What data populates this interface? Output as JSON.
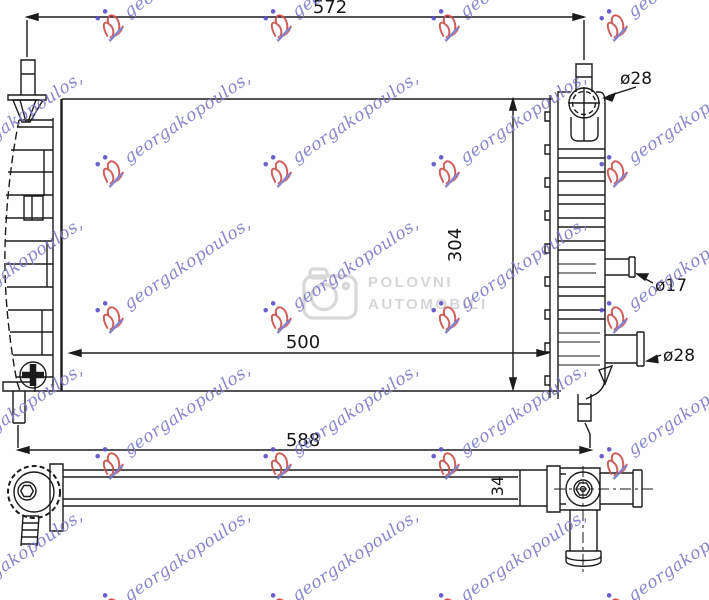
{
  "drawing": {
    "type": "radiator-technical-drawing",
    "line_color": "#1b1b1b",
    "dimensions": {
      "top_width": "572",
      "core_height": "304",
      "core_width": "500",
      "bottom_width": "588",
      "core_thickness": "34",
      "filler_neck_diameter": "ø28",
      "small_pipe_diameter": "ø17",
      "bottom_pipe_diameter": "ø28"
    }
  },
  "watermark": {
    "text": "georgakopoulos,",
    "text_color": "#7b7bc8",
    "logo_color": "#c9504b",
    "dot_color": "#5b4fc8",
    "underline_color": "#7878c6",
    "angle_deg": -34,
    "grid": {
      "x0": -68,
      "y0": 15,
      "dx": 168,
      "dy": 146,
      "cols": 5,
      "rows": 5
    }
  },
  "site_watermark": {
    "icon": "camera-icon",
    "line1": "POLOVNI",
    "line2": "AUTOMOBILI",
    "color": "#d6d6d6"
  }
}
